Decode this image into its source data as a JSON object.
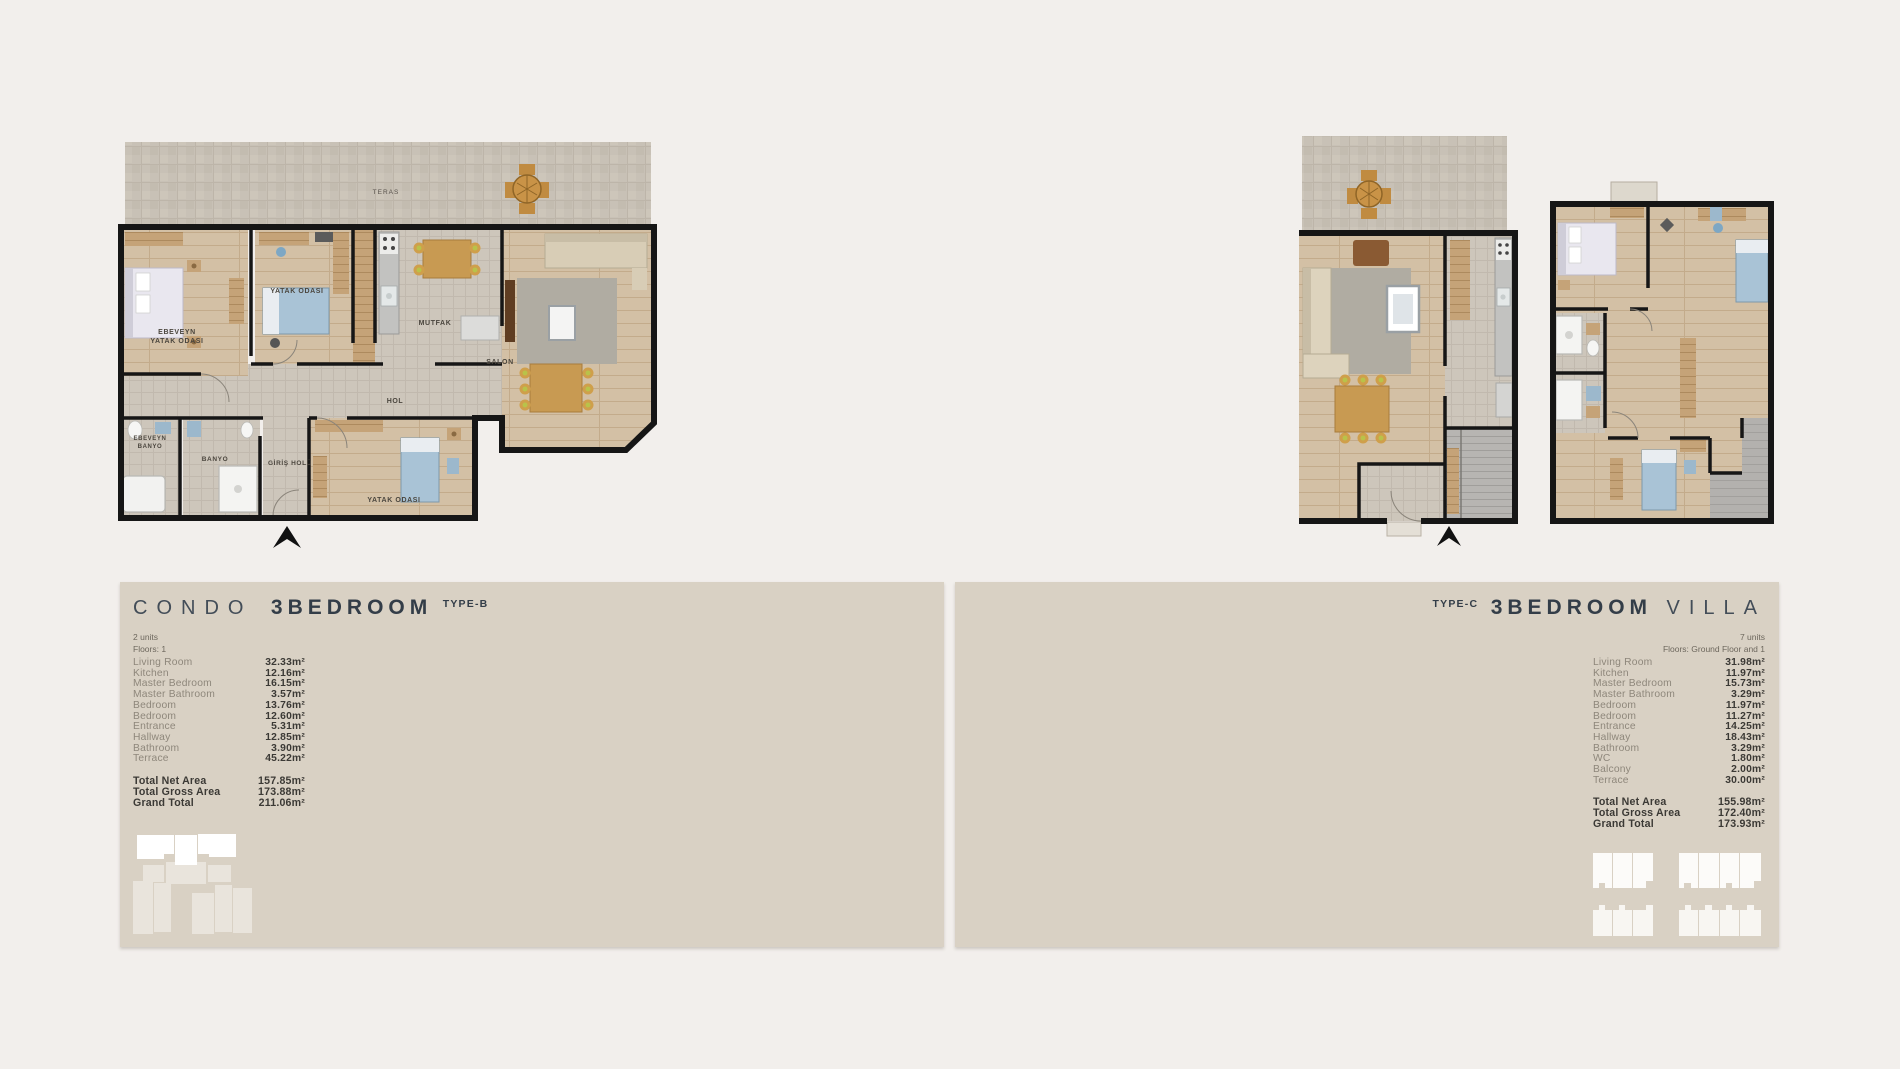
{
  "colors": {
    "page_bg": "#f2efec",
    "panel_bg": "#d9d1c4",
    "title_text": "#39434e",
    "room_name_text": "#8e877b",
    "room_value_text": "#3b3935",
    "wall": "#161616",
    "wood_floor": "#d2bfa4",
    "tile_floor": "#cbc4b9",
    "bed_blue": "#a9c3d6"
  },
  "left_section": {
    "title": {
      "light": "CONDO",
      "bold": "3BEDROOM",
      "type": "TYPE-B"
    },
    "meta": {
      "units": "2 units",
      "floors": "Floors: 1"
    },
    "rooms": [
      {
        "name": "Living Room",
        "area": "32.33m²"
      },
      {
        "name": "Kitchen",
        "area": "12.16m²"
      },
      {
        "name": "Master Bedroom",
        "area": "16.15m²"
      },
      {
        "name": "Master Bathroom",
        "area": "3.57m²"
      },
      {
        "name": "Bedroom",
        "area": "13.76m²"
      },
      {
        "name": "Bedroom",
        "area": "12.60m²"
      },
      {
        "name": "Entrance",
        "area": "5.31m²"
      },
      {
        "name": "Hallway",
        "area": "12.85m²"
      },
      {
        "name": "Bathroom",
        "area": "3.90m²"
      },
      {
        "name": "Terrace",
        "area": "45.22m²"
      }
    ],
    "totals": [
      {
        "name": "Total Net Area",
        "area": "157.85m²"
      },
      {
        "name": "Total Gross Area",
        "area": "173.88m²"
      },
      {
        "name": "Grand Total",
        "area": "211.06m²"
      }
    ],
    "floorplan_labels": {
      "terrace": "TERAS",
      "master_bedroom_l1": "EBEVEYN",
      "master_bedroom_l2": "YATAK ODASI",
      "bedroom_top": "YATAK ODASI",
      "kitchen": "MUTFAK",
      "living": "SALON",
      "hall": "HOL",
      "master_bath_l1": "EBEVEYN",
      "master_bath_l2": "BANYO",
      "bath": "BANYO",
      "entrance": "GİRİŞ HOLÜ",
      "bedroom_bottom": "YATAK ODASI"
    }
  },
  "right_section": {
    "title": {
      "type": "TYPE-C",
      "bold": "3BEDROOM",
      "light": "VILLA"
    },
    "meta": {
      "units": "7 units",
      "floors": "Floors: Ground Floor and 1"
    },
    "rooms": [
      {
        "name": "Living Room",
        "area": "31.98m²"
      },
      {
        "name": "Kitchen",
        "area": "11.97m²"
      },
      {
        "name": "Master Bedroom",
        "area": "15.73m²"
      },
      {
        "name": "Master Bathroom",
        "area": "3.29m²"
      },
      {
        "name": "Bedroom",
        "area": "11.97m²"
      },
      {
        "name": "Bedroom",
        "area": "11.27m²"
      },
      {
        "name": "Entrance",
        "area": "14.25m²"
      },
      {
        "name": "Hallway",
        "area": "18.43m²"
      },
      {
        "name": "Bathroom",
        "area": "3.29m²"
      },
      {
        "name": "WC",
        "area": "1.80m²"
      },
      {
        "name": "Balcony",
        "area": "2.00m²"
      },
      {
        "name": "Terrace",
        "area": "30.00m²"
      }
    ],
    "totals": [
      {
        "name": "Total Net Area",
        "area": "155.98m²"
      },
      {
        "name": "Total Gross Area",
        "area": "172.40m²"
      },
      {
        "name": "Grand Total",
        "area": "173.93m²"
      }
    ]
  }
}
